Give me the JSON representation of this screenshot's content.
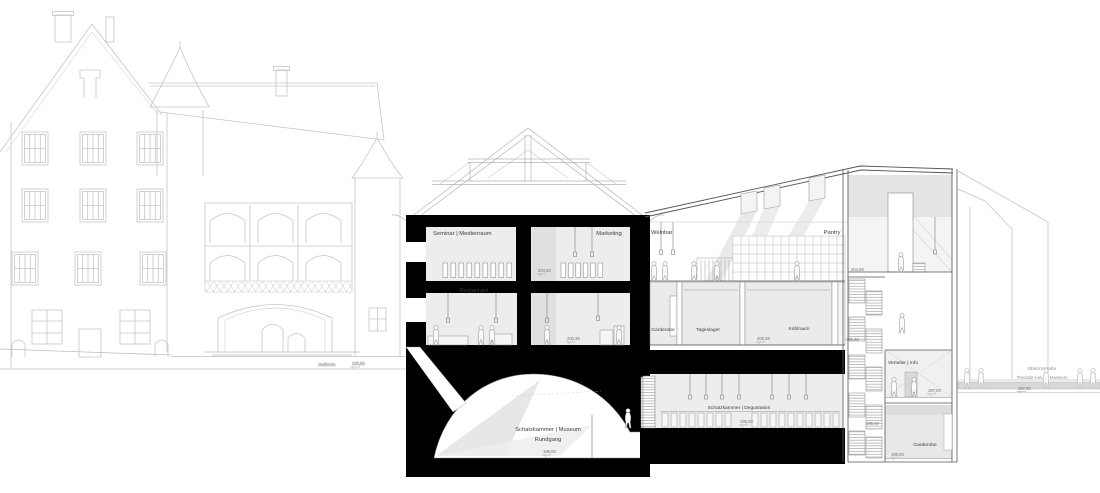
{
  "rooms": {
    "seminar": "Seminar | Medienraum",
    "marketing": "Marketing",
    "weinbar": "Weinbar",
    "pantry": "Pantry",
    "restaurant": "Restaurant",
    "garderobe_eg": "Garderobe",
    "tageslager": "Tageslager",
    "kuehlraum": "Kühlraum",
    "schatzkammer_museum_line1": "Schatzkammer | Museum",
    "schatzkammer_museum_line2": "Rundgang",
    "schatzkammer_degustation": "Schatzkammer | Degustation",
    "verteiler_info": "Verteiler | Info",
    "garderobe_ug": "Garderobe"
  },
  "levels": {
    "upper_floor": "204,50",
    "ground_floor": "200,36",
    "street": "197,00",
    "basement": "195,00",
    "terrain": "195,50"
  },
  "site": {
    "terrain_label": "Gelände",
    "street_name": "Obertorstraße",
    "street_building": "Theodor-Heuss-Museum"
  },
  "colors": {
    "cut_fill": "#000000",
    "elevation_line": "#c6c6c6",
    "room_fill": "#ececec",
    "paper": "#ffffff"
  }
}
